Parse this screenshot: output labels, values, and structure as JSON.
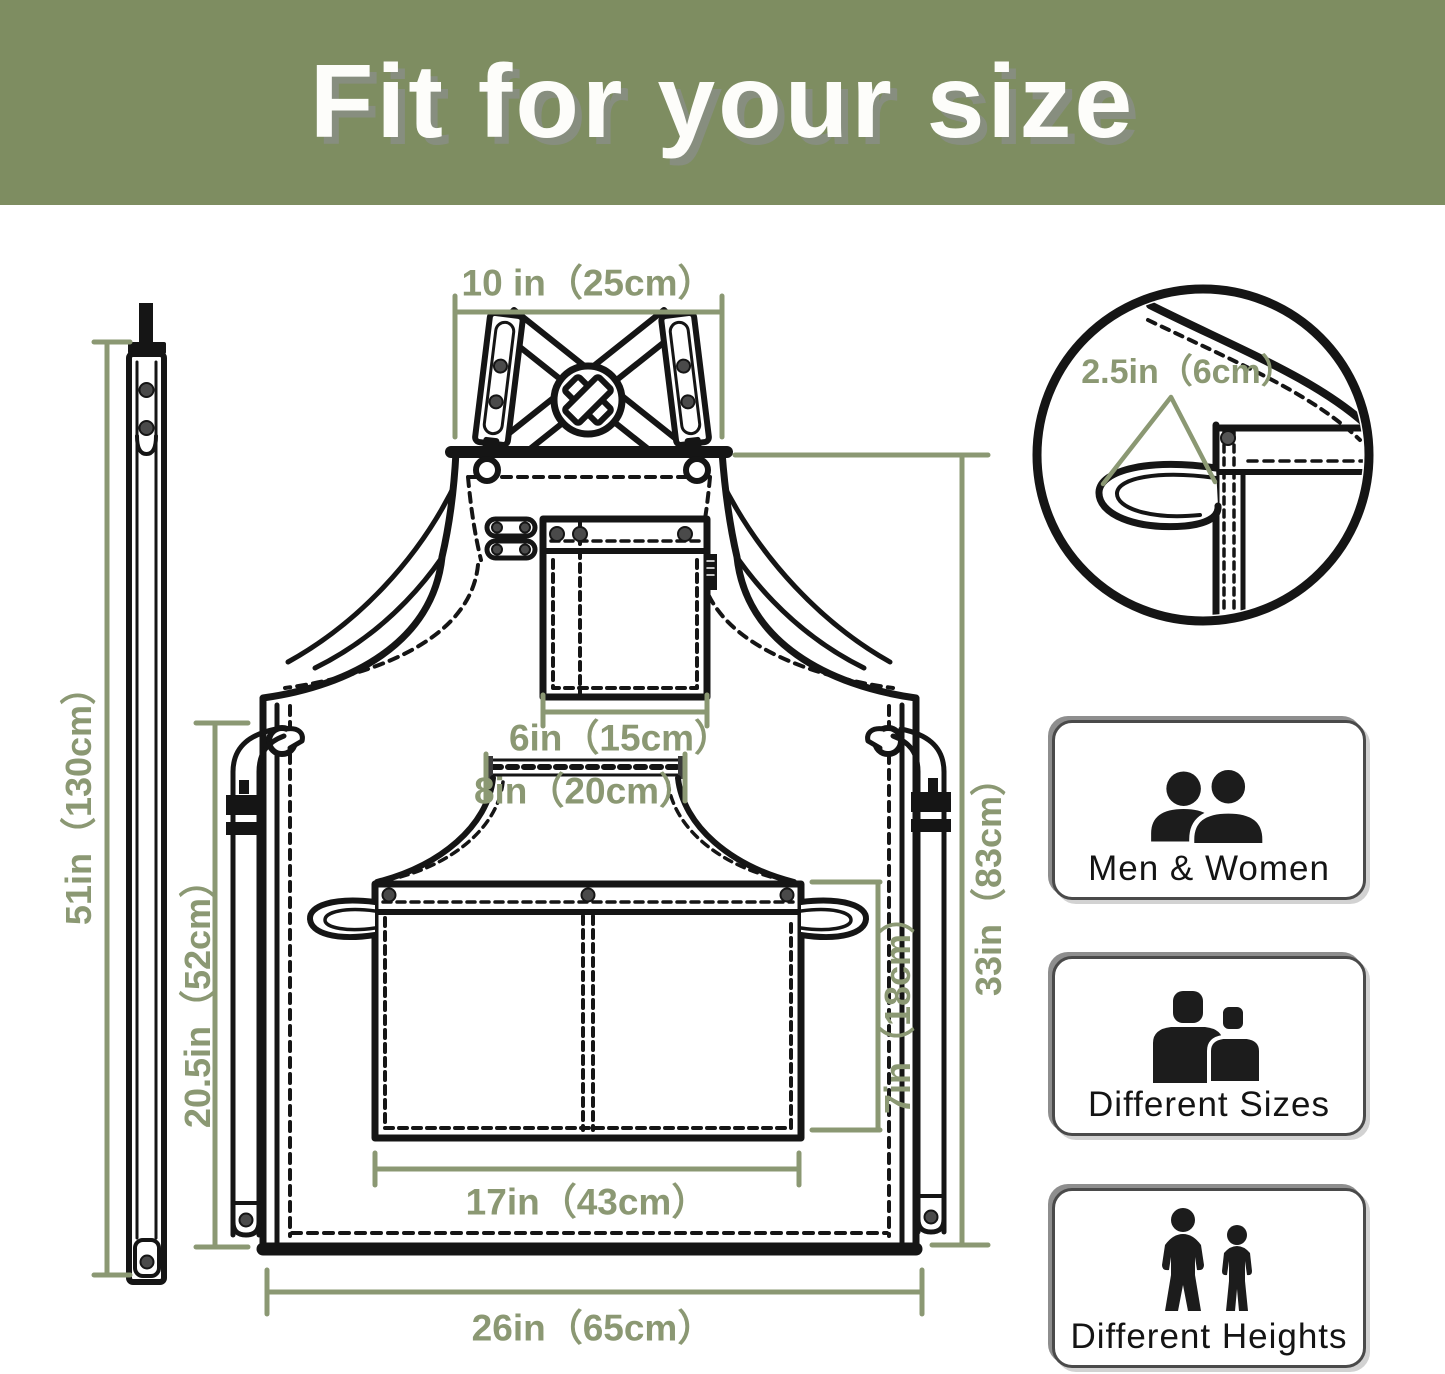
{
  "header": {
    "title": "Fit for your size",
    "background_color": "#7e8d61",
    "title_color": "#ffffff"
  },
  "diagram": {
    "accent_color": "#8b9873",
    "line_color": "#151515",
    "labels": {
      "neck_strap_top_width": "10 in（25cm）",
      "chest_pocket_width": "6in（15cm）",
      "waist_opening_width": "8in（20cm）",
      "waist_pocket_width": "17in（43cm）",
      "waist_pocket_height": "7in（18cm）",
      "body_length": "33in（83cm）",
      "side_strap_length": "20.5in（52cm）",
      "full_strap_length": "51in（130cm）",
      "hem_width": "26in（65cm）",
      "towel_loop_width": "2.5in（6cm）"
    }
  },
  "features": [
    {
      "id": "men-women",
      "label": "Men & Women"
    },
    {
      "id": "different-sizes",
      "label": "Different Sizes"
    },
    {
      "id": "different-heights",
      "label": "Different Heights"
    }
  ]
}
